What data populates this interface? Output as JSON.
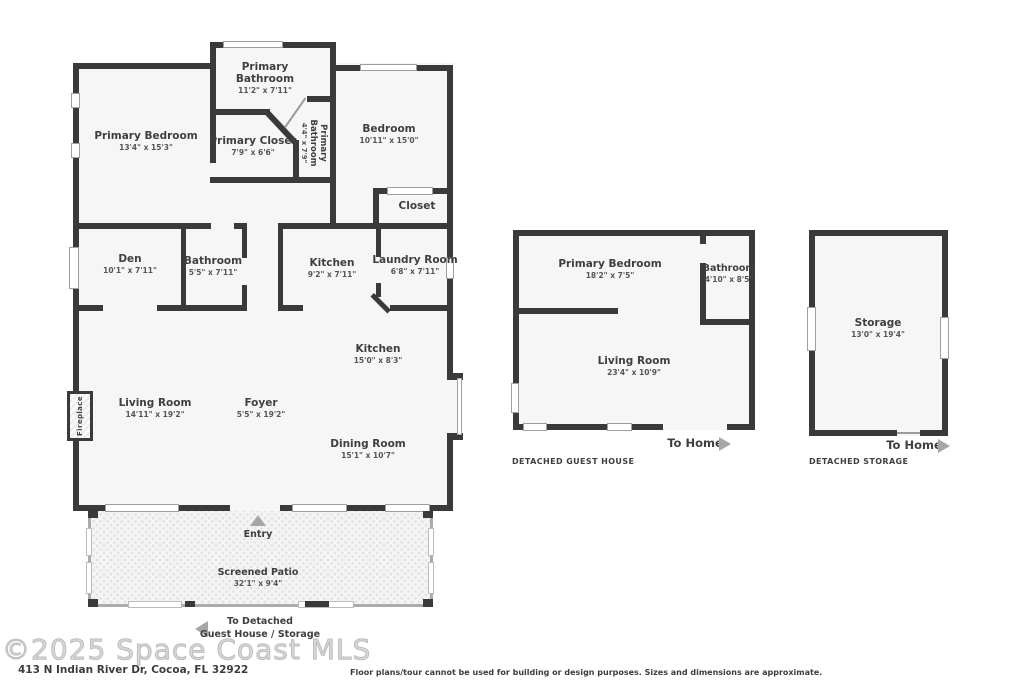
{
  "watermark": "©2025 Space Coast MLS",
  "address": "413 N Indian River Dr, Cocoa, FL 32922",
  "disclaimer": "Floor plans/tour cannot be used for building or design purposes. Sizes and dimensions are approximate.",
  "colors": {
    "wall": "#3a3a3a",
    "label_text": "#3f3f3f",
    "arrow": "#a6a6a6",
    "room_fill": "#f6f6f6"
  },
  "main_house": {
    "entry_label": "Entry",
    "fireplace_label": "Fireplace",
    "to_detached": {
      "line1": "To Detached",
      "line2": "Guest House / Storage"
    },
    "rooms": [
      {
        "name": "Primary Bedroom",
        "dims": "13'4\" x 15'3\""
      },
      {
        "name": "Primary Bathroom",
        "dims": "11'2\" x 7'11\""
      },
      {
        "name": "Primary Closet",
        "dims": "7'9\" x 6'6\""
      },
      {
        "name": "Primary Bathroom",
        "dims": "4'4\" x 7'9\""
      },
      {
        "name": "Bedroom",
        "dims": "10'11\" x 15'0\""
      },
      {
        "name": "Closet",
        "dims": ""
      },
      {
        "name": "Den",
        "dims": "10'1\" x 7'11\""
      },
      {
        "name": "Bathroom",
        "dims": "5'5\" x 7'11\""
      },
      {
        "name": "Kitchen",
        "dims": "9'2\" x 7'11\""
      },
      {
        "name": "Laundry Room",
        "dims": "6'8\" x 7'11\""
      },
      {
        "name": "Kitchen",
        "dims": "15'0\" x 8'3\""
      },
      {
        "name": "Living Room",
        "dims": "14'11\" x 19'2\""
      },
      {
        "name": "Foyer",
        "dims": "5'5\" x 19'2\""
      },
      {
        "name": "Dining Room",
        "dims": "15'1\" x 10'7\""
      },
      {
        "name": "Screened Patio",
        "dims": "32'1\" x 9'4\""
      }
    ]
  },
  "guest_house": {
    "caption": "DETACHED GUEST HOUSE",
    "to_home": "To Home",
    "rooms": [
      {
        "name": "Primary Bedroom",
        "dims": "18'2\" x 7'5\""
      },
      {
        "name": "Bathroom",
        "dims": "4'10\" x 8'5\""
      },
      {
        "name": "Living Room",
        "dims": "23'4\" x 10'9\""
      }
    ]
  },
  "detached_storage": {
    "caption": "DETACHED STORAGE",
    "to_home": "To Home",
    "rooms": [
      {
        "name": "Storage",
        "dims": "13'0\" x 19'4\""
      }
    ]
  }
}
